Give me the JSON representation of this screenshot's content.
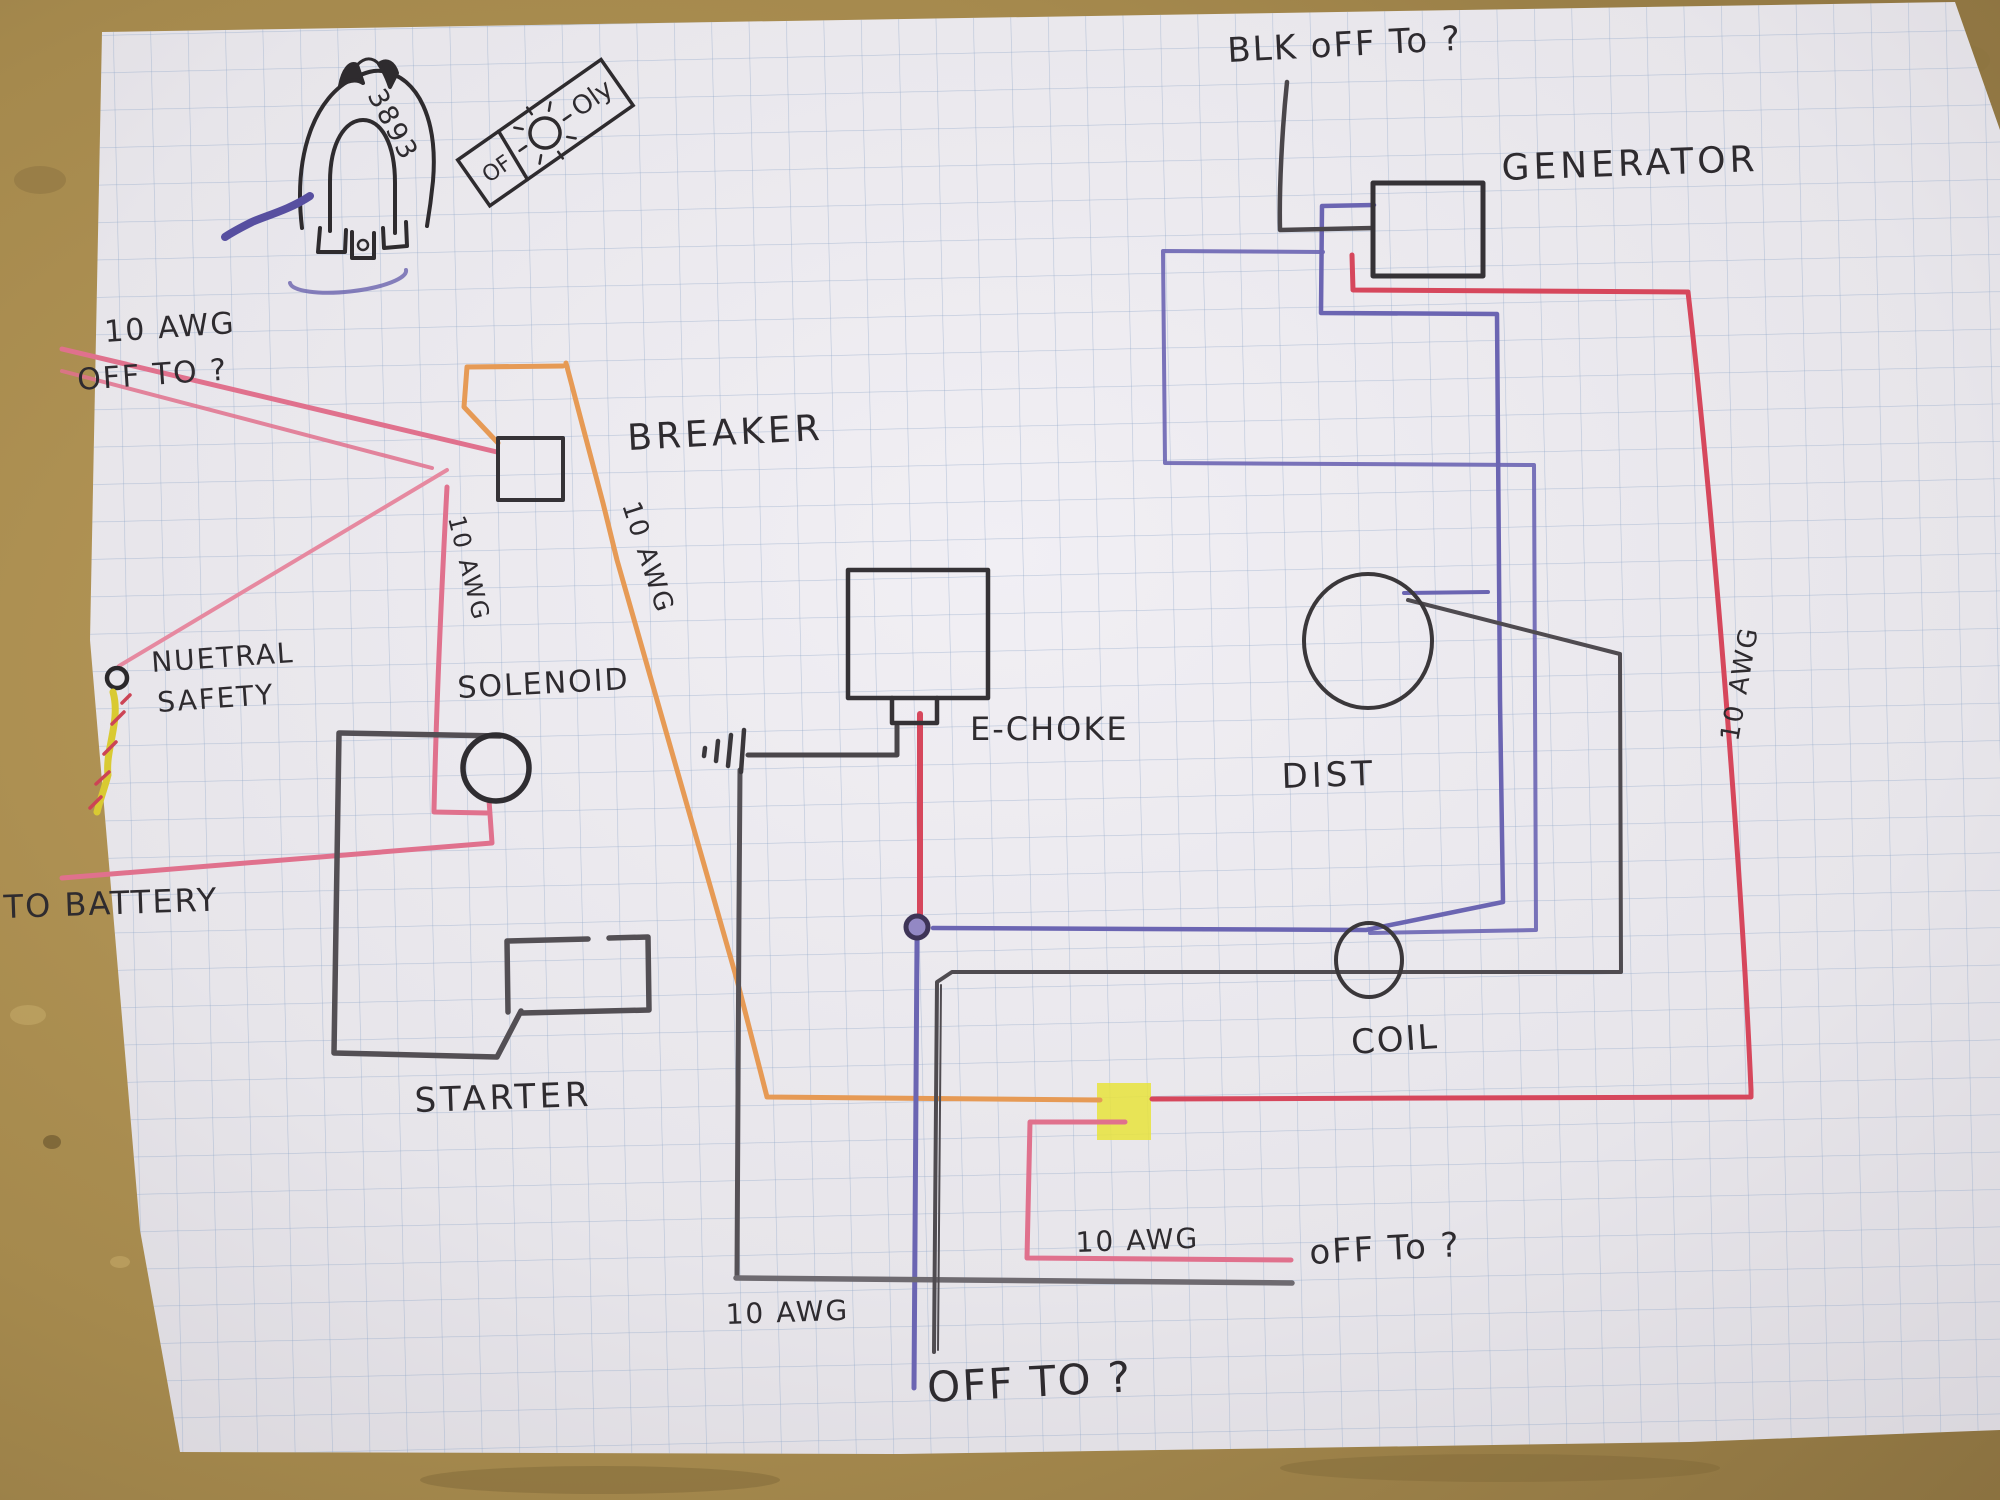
{
  "scene": {
    "description": "photo of a hand-drawn automotive wiring diagram on blue graph paper lying on a tan table",
    "table_color": "#a5894d",
    "paper_color": "#edebf0",
    "grid_color": "#8ea6c6"
  },
  "wire_colors": {
    "black_ink": "#353236",
    "pencil_gray": "#67636a",
    "pink": "#e0718d",
    "red": "#d6475c",
    "orange": "#e69a55",
    "blue_violet": "#6b65b2",
    "yellow_crayon": "#d9ca32",
    "marker_yellow_junction": "#e8e33c"
  },
  "labels": {
    "blk_off_to": "BLK oFF To ?",
    "generator": "GENERATOR",
    "awg_top_left": "10 AWG",
    "off_to_top_left": "OFF TO ?",
    "breaker": "BREAKER",
    "awg_pink_vertical": "10 AWG",
    "awg_orange_diagonal": "10 AWG",
    "neutral_line1": "NUETRAL",
    "neutral_line2": "SAFETY",
    "solenoid": "SOLENOID",
    "to_battery": "TO BATTERY",
    "starter": "STARTER",
    "e_choke": "E-CHOKE",
    "dist": "DIST",
    "coil": "COIL",
    "awg_bottom_center": "10 AWG",
    "off_to_bottom_center": "OFF TO ?",
    "awg_bottom_right": "10 AWG",
    "off_to_bottom_right": "oFF To ?",
    "awg_right_vertical": "10 AWG",
    "part_number": "3893",
    "gauge_top": "Oly",
    "gauge_bottom": "OF"
  }
}
